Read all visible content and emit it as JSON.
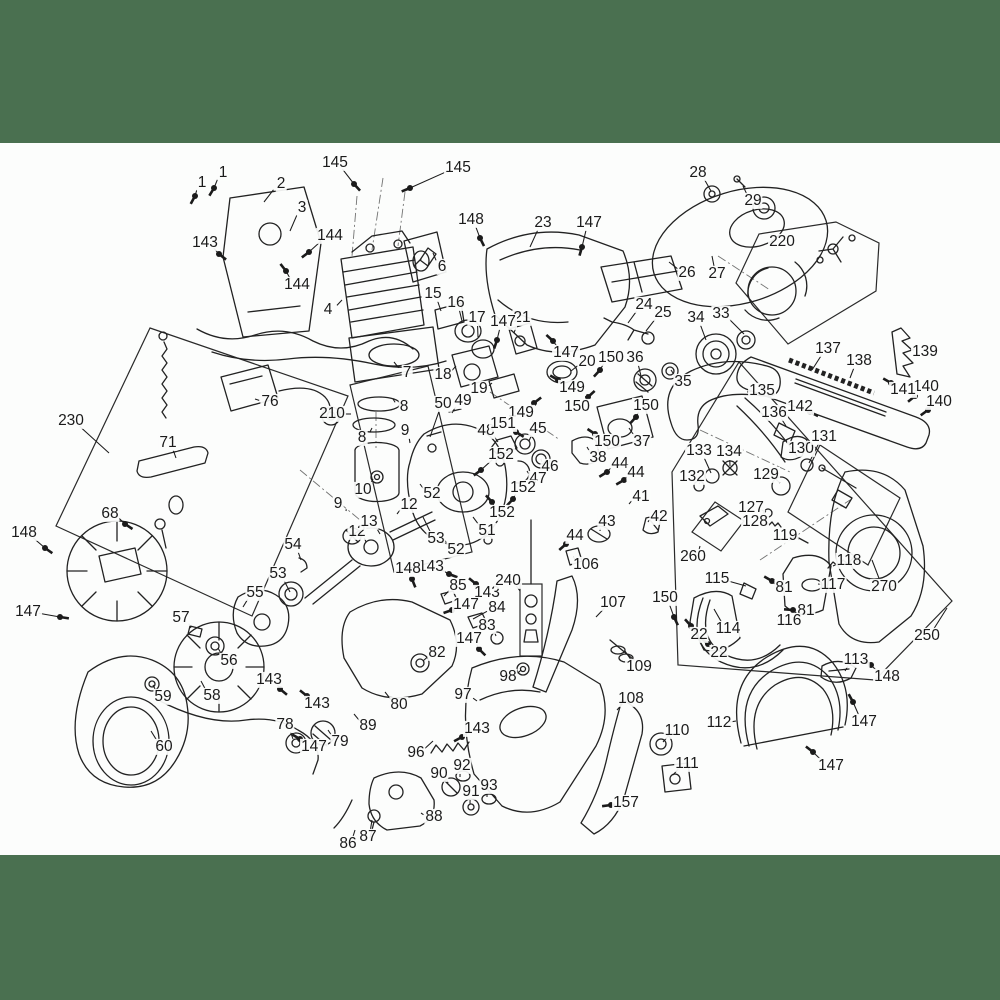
{
  "page": {
    "background": "#fcfdfc",
    "band_color": "#4a7050",
    "top_band": {
      "y": 0,
      "h": 143
    },
    "bottom_band": {
      "y": 855,
      "h": 145
    },
    "line_color": "#222222",
    "description": "Chainsaw exploded-view parts diagram with numbered callouts"
  },
  "callouts": [
    {
      "n": "1",
      "x": 223,
      "y": 173,
      "tx": 214,
      "ty": 188,
      "hw": 1
    },
    {
      "n": "1",
      "x": 202,
      "y": 183,
      "tx": 195,
      "ty": 196,
      "hw": 1
    },
    {
      "n": "2",
      "x": 281,
      "y": 184,
      "tx": 264,
      "ty": 202
    },
    {
      "n": "3",
      "x": 302,
      "y": 208,
      "tx": 290,
      "ty": 231
    },
    {
      "n": "143",
      "x": 205,
      "y": 243,
      "tx": 219,
      "ty": 254,
      "hw": 1
    },
    {
      "n": "144",
      "x": 330,
      "y": 236,
      "tx": 309,
      "ty": 252,
      "hw": 1
    },
    {
      "n": "144",
      "x": 297,
      "y": 285,
      "tx": 286,
      "ty": 271,
      "hw": 1
    },
    {
      "n": "145",
      "x": 335,
      "y": 163,
      "tx": 354,
      "ty": 184,
      "hw": 1
    },
    {
      "n": "145",
      "x": 458,
      "y": 168,
      "tx": 410,
      "ty": 188,
      "hw": 1
    },
    {
      "n": "4",
      "x": 328,
      "y": 310,
      "tx": 342,
      "ty": 300
    },
    {
      "n": "6",
      "x": 442,
      "y": 267,
      "tx": 433,
      "ty": 253
    },
    {
      "n": "7",
      "x": 407,
      "y": 373,
      "tx": 394,
      "ty": 362
    },
    {
      "n": "15",
      "x": 433,
      "y": 294,
      "tx": 441,
      "ty": 311
    },
    {
      "n": "16",
      "x": 456,
      "y": 303,
      "tx": 462,
      "ty": 321
    },
    {
      "n": "17",
      "x": 477,
      "y": 318,
      "tx": 478,
      "ty": 337
    },
    {
      "n": "18",
      "x": 443,
      "y": 375,
      "tx": 456,
      "ty": 366
    },
    {
      "n": "19",
      "x": 479,
      "y": 389,
      "tx": 492,
      "ty": 383
    },
    {
      "n": "20",
      "x": 587,
      "y": 362,
      "tx": 571,
      "ty": 371
    },
    {
      "n": "21",
      "x": 522,
      "y": 318,
      "tx": 514,
      "ty": 333
    },
    {
      "n": "23",
      "x": 543,
      "y": 223,
      "tx": 530,
      "ty": 247
    },
    {
      "n": "24",
      "x": 644,
      "y": 305,
      "tx": 628,
      "ty": 323
    },
    {
      "n": "25",
      "x": 663,
      "y": 313,
      "tx": 646,
      "ty": 331
    },
    {
      "n": "26",
      "x": 687,
      "y": 273,
      "tx": 669,
      "ty": 262
    },
    {
      "n": "27",
      "x": 717,
      "y": 274,
      "tx": 712,
      "ty": 256
    },
    {
      "n": "28",
      "x": 698,
      "y": 173,
      "tx": 711,
      "ty": 191
    },
    {
      "n": "29",
      "x": 753,
      "y": 201,
      "tx": 743,
      "ty": 186
    },
    {
      "n": "33",
      "x": 721,
      "y": 314,
      "tx": 744,
      "ty": 334
    },
    {
      "n": "34",
      "x": 696,
      "y": 318,
      "tx": 706,
      "ty": 340
    },
    {
      "n": "35",
      "x": 683,
      "y": 382,
      "tx": 671,
      "ty": 370
    },
    {
      "n": "36",
      "x": 635,
      "y": 358,
      "tx": 641,
      "ty": 376
    },
    {
      "n": "37",
      "x": 642,
      "y": 442,
      "tx": 629,
      "ty": 428
    },
    {
      "n": "38",
      "x": 598,
      "y": 458,
      "tx": 587,
      "ty": 447
    },
    {
      "n": "41",
      "x": 641,
      "y": 497,
      "tx": 629,
      "ty": 504
    },
    {
      "n": "42",
      "x": 659,
      "y": 517,
      "tx": 648,
      "ty": 522
    },
    {
      "n": "43",
      "x": 607,
      "y": 522,
      "tx": 600,
      "ty": 531
    },
    {
      "n": "44",
      "x": 620,
      "y": 464,
      "tx": 607,
      "ty": 472,
      "hw": 1
    },
    {
      "n": "44",
      "x": 636,
      "y": 473,
      "tx": 624,
      "ty": 480,
      "hw": 1
    },
    {
      "n": "44",
      "x": 575,
      "y": 536,
      "tx": 566,
      "ty": 544,
      "hw": 1
    },
    {
      "n": "45",
      "x": 538,
      "y": 429,
      "tx": 529,
      "ty": 441
    },
    {
      "n": "46",
      "x": 550,
      "y": 467,
      "tx": 541,
      "ty": 459
    },
    {
      "n": "47",
      "x": 538,
      "y": 479,
      "tx": 527,
      "ty": 471
    },
    {
      "n": "48",
      "x": 486,
      "y": 431,
      "tx": 498,
      "ty": 442
    },
    {
      "n": "49",
      "x": 463,
      "y": 401,
      "tx": 452,
      "ty": 413
    },
    {
      "n": "50",
      "x": 443,
      "y": 404,
      "tx": 430,
      "ty": 437
    },
    {
      "n": "51",
      "x": 487,
      "y": 531,
      "tx": 473,
      "ty": 517
    },
    {
      "n": "52",
      "x": 432,
      "y": 494,
      "tx": 420,
      "ty": 484
    },
    {
      "n": "52",
      "x": 456,
      "y": 550,
      "tx": 442,
      "ty": 537
    },
    {
      "n": "53",
      "x": 436,
      "y": 539,
      "tx": 423,
      "ty": 517
    },
    {
      "n": "53",
      "x": 278,
      "y": 574,
      "tx": 290,
      "ty": 592
    },
    {
      "n": "54",
      "x": 293,
      "y": 545,
      "tx": 301,
      "ty": 560
    },
    {
      "n": "55",
      "x": 255,
      "y": 593,
      "tx": 243,
      "ty": 607
    },
    {
      "n": "56",
      "x": 229,
      "y": 661,
      "tx": 218,
      "ty": 648
    },
    {
      "n": "57",
      "x": 181,
      "y": 618,
      "tx": 191,
      "ty": 628
    },
    {
      "n": "58",
      "x": 212,
      "y": 696,
      "tx": 201,
      "ty": 681
    },
    {
      "n": "59",
      "x": 163,
      "y": 697,
      "tx": 153,
      "ty": 685
    },
    {
      "n": "60",
      "x": 164,
      "y": 747,
      "tx": 151,
      "ty": 731
    },
    {
      "n": "68",
      "x": 110,
      "y": 514,
      "tx": 125,
      "ty": 524,
      "hw": 1
    },
    {
      "n": "71",
      "x": 168,
      "y": 443,
      "tx": 176,
      "ty": 458
    },
    {
      "n": "76",
      "x": 270,
      "y": 402,
      "tx": 255,
      "ty": 399
    },
    {
      "n": "78",
      "x": 285,
      "y": 725,
      "tx": 293,
      "ty": 739
    },
    {
      "n": "79",
      "x": 340,
      "y": 742,
      "tx": 328,
      "ty": 730
    },
    {
      "n": "80",
      "x": 399,
      "y": 705,
      "tx": 385,
      "ty": 692
    },
    {
      "n": "81",
      "x": 784,
      "y": 588,
      "tx": 772,
      "ty": 581,
      "hw": 1
    },
    {
      "n": "81",
      "x": 806,
      "y": 611,
      "tx": 793,
      "ty": 610,
      "hw": 1
    },
    {
      "n": "82",
      "x": 437,
      "y": 653,
      "tx": 423,
      "ty": 661
    },
    {
      "n": "83",
      "x": 487,
      "y": 626,
      "tx": 496,
      "ty": 636
    },
    {
      "n": "84",
      "x": 497,
      "y": 608,
      "tx": 473,
      "ty": 619
    },
    {
      "n": "85",
      "x": 458,
      "y": 586,
      "tx": 444,
      "ty": 596
    },
    {
      "n": "86",
      "x": 348,
      "y": 844,
      "tx": 355,
      "ty": 830
    },
    {
      "n": "87",
      "x": 368,
      "y": 837,
      "tx": 372,
      "ty": 820
    },
    {
      "n": "88",
      "x": 434,
      "y": 817,
      "tx": 421,
      "ty": 813
    },
    {
      "n": "89",
      "x": 368,
      "y": 726,
      "tx": 354,
      "ty": 714
    },
    {
      "n": "90",
      "x": 439,
      "y": 774,
      "tx": 448,
      "ty": 783
    },
    {
      "n": "91",
      "x": 471,
      "y": 792,
      "tx": 470,
      "ty": 804
    },
    {
      "n": "92",
      "x": 462,
      "y": 766,
      "tx": 460,
      "ty": 777
    },
    {
      "n": "93",
      "x": 489,
      "y": 786,
      "tx": 487,
      "ty": 797
    },
    {
      "n": "96",
      "x": 416,
      "y": 753,
      "tx": 433,
      "ty": 741
    },
    {
      "n": "97",
      "x": 463,
      "y": 695,
      "tx": 477,
      "ty": 701
    },
    {
      "n": "98",
      "x": 508,
      "y": 677,
      "tx": 521,
      "ty": 670
    },
    {
      "n": "106",
      "x": 586,
      "y": 565,
      "tx": 573,
      "ty": 557
    },
    {
      "n": "107",
      "x": 613,
      "y": 603,
      "tx": 596,
      "ty": 617
    },
    {
      "n": "108",
      "x": 631,
      "y": 699,
      "tx": 617,
      "ty": 710
    },
    {
      "n": "109",
      "x": 639,
      "y": 667,
      "tx": 625,
      "ty": 651
    },
    {
      "n": "110",
      "x": 677,
      "y": 731,
      "tx": 663,
      "ty": 742
    },
    {
      "n": "111",
      "x": 687,
      "y": 764,
      "tx": 673,
      "ty": 775
    },
    {
      "n": "112",
      "x": 719,
      "y": 723,
      "tx": 736,
      "ty": 721
    },
    {
      "n": "113",
      "x": 856,
      "y": 660,
      "tx": 845,
      "ty": 671
    },
    {
      "n": "114",
      "x": 728,
      "y": 629,
      "tx": 714,
      "ty": 609
    },
    {
      "n": "115",
      "x": 717,
      "y": 579,
      "tx": 746,
      "ty": 586
    },
    {
      "n": "116",
      "x": 789,
      "y": 621,
      "tx": 777,
      "ty": 620
    },
    {
      "n": "117",
      "x": 833,
      "y": 585,
      "tx": 818,
      "ty": 584
    },
    {
      "n": "118",
      "x": 849,
      "y": 561,
      "tx": 833,
      "ty": 566
    },
    {
      "n": "119",
      "x": 785,
      "y": 536,
      "tx": 799,
      "ty": 539
    },
    {
      "n": "127",
      "x": 751,
      "y": 508,
      "tx": 766,
      "ty": 512
    },
    {
      "n": "128",
      "x": 755,
      "y": 522,
      "tx": 768,
      "ty": 525
    },
    {
      "n": "129",
      "x": 766,
      "y": 475,
      "tx": 780,
      "ty": 483
    },
    {
      "n": "130",
      "x": 801,
      "y": 449,
      "tx": 789,
      "ty": 450
    },
    {
      "n": "131",
      "x": 824,
      "y": 437,
      "tx": 809,
      "ty": 463
    },
    {
      "n": "132",
      "x": 692,
      "y": 477,
      "tx": 699,
      "ty": 484
    },
    {
      "n": "133",
      "x": 699,
      "y": 451,
      "tx": 711,
      "ty": 473
    },
    {
      "n": "134",
      "x": 729,
      "y": 452,
      "tx": 730,
      "ty": 466
    },
    {
      "n": "135",
      "x": 762,
      "y": 391,
      "tx": 747,
      "ty": 392
    },
    {
      "n": "136",
      "x": 774,
      "y": 413,
      "tx": 786,
      "ty": 426
    },
    {
      "n": "137",
      "x": 828,
      "y": 349,
      "tx": 812,
      "ty": 370
    },
    {
      "n": "138",
      "x": 859,
      "y": 361,
      "tx": 850,
      "ty": 378
    },
    {
      "n": "139",
      "x": 925,
      "y": 352,
      "tx": 912,
      "ty": 349
    },
    {
      "n": "140",
      "x": 926,
      "y": 387,
      "tx": 915,
      "ty": 396,
      "hw": 1
    },
    {
      "n": "140",
      "x": 939,
      "y": 402,
      "tx": 928,
      "ty": 410,
      "hw": 1
    },
    {
      "n": "141",
      "x": 903,
      "y": 390,
      "tx": 891,
      "ty": 383,
      "hw": 1
    },
    {
      "n": "142",
      "x": 800,
      "y": 407,
      "tx": 810,
      "ty": 412,
      "hw": 1
    },
    {
      "n": "143",
      "x": 431,
      "y": 567,
      "tx": 449,
      "ty": 574,
      "hw": 1
    },
    {
      "n": "143",
      "x": 487,
      "y": 593,
      "tx": 476,
      "ty": 584,
      "hw": 1
    },
    {
      "n": "143",
      "x": 269,
      "y": 680,
      "tx": 280,
      "ty": 689,
      "hw": 1
    },
    {
      "n": "143",
      "x": 317,
      "y": 704,
      "tx": 307,
      "ty": 696,
      "hw": 1
    },
    {
      "n": "143",
      "x": 477,
      "y": 729,
      "tx": 462,
      "ty": 737,
      "hw": 1
    },
    {
      "n": "147",
      "x": 589,
      "y": 223,
      "tx": 582,
      "ty": 247,
      "hw": 1
    },
    {
      "n": "147",
      "x": 503,
      "y": 322,
      "tx": 497,
      "ty": 340,
      "hw": 1
    },
    {
      "n": "147",
      "x": 566,
      "y": 353,
      "tx": 553,
      "ty": 341,
      "hw": 1
    },
    {
      "n": "147",
      "x": 28,
      "y": 612,
      "tx": 60,
      "ty": 617,
      "hw": 1
    },
    {
      "n": "147",
      "x": 466,
      "y": 605,
      "tx": 452,
      "ty": 610,
      "hw": 1
    },
    {
      "n": "147",
      "x": 469,
      "y": 639,
      "tx": 479,
      "ty": 649,
      "hw": 1
    },
    {
      "n": "147",
      "x": 314,
      "y": 747,
      "tx": 300,
      "ty": 739,
      "hw": 1
    },
    {
      "n": "147",
      "x": 864,
      "y": 722,
      "tx": 853,
      "ty": 702,
      "hw": 1
    },
    {
      "n": "147",
      "x": 831,
      "y": 766,
      "tx": 813,
      "ty": 752,
      "hw": 1
    },
    {
      "n": "148",
      "x": 471,
      "y": 220,
      "tx": 480,
      "ty": 238,
      "hw": 1
    },
    {
      "n": "148",
      "x": 24,
      "y": 533,
      "tx": 45,
      "ty": 548,
      "hw": 1
    },
    {
      "n": "148",
      "x": 408,
      "y": 569,
      "tx": 412,
      "ty": 579,
      "hw": 1
    },
    {
      "n": "148",
      "x": 887,
      "y": 677,
      "tx": 871,
      "ty": 665,
      "hw": 1
    },
    {
      "n": "149",
      "x": 572,
      "y": 388,
      "tx": 558,
      "ty": 380,
      "hw": 1
    },
    {
      "n": "149",
      "x": 521,
      "y": 413,
      "tx": 534,
      "ty": 403,
      "hw": 1
    },
    {
      "n": "150",
      "x": 611,
      "y": 358,
      "tx": 600,
      "ty": 370,
      "hw": 1
    },
    {
      "n": "150",
      "x": 577,
      "y": 407,
      "tx": 588,
      "ty": 397,
      "hw": 1
    },
    {
      "n": "150",
      "x": 646,
      "y": 406,
      "tx": 636,
      "ty": 417,
      "hw": 1
    },
    {
      "n": "150",
      "x": 607,
      "y": 442,
      "tx": 595,
      "ty": 434,
      "hw": 1
    },
    {
      "n": "150",
      "x": 665,
      "y": 598,
      "tx": 674,
      "ty": 617,
      "hw": 1
    },
    {
      "n": "151",
      "x": 503,
      "y": 424,
      "tx": 516,
      "ty": 432,
      "hw": 1
    },
    {
      "n": "152",
      "x": 501,
      "y": 455,
      "tx": 481,
      "ty": 470,
      "hw": 1
    },
    {
      "n": "152",
      "x": 523,
      "y": 488,
      "tx": 513,
      "ty": 499,
      "hw": 1
    },
    {
      "n": "152",
      "x": 502,
      "y": 513,
      "tx": 492,
      "ty": 502,
      "hw": 1
    },
    {
      "n": "157",
      "x": 626,
      "y": 803,
      "tx": 611,
      "ty": 805,
      "hw": 1
    },
    {
      "n": "8",
      "x": 404,
      "y": 407,
      "tx": 393,
      "ty": 399
    },
    {
      "n": "8",
      "x": 362,
      "y": 438,
      "tx": 372,
      "ty": 428
    },
    {
      "n": "9",
      "x": 405,
      "y": 431,
      "tx": 410,
      "ty": 443
    },
    {
      "n": "9",
      "x": 338,
      "y": 504,
      "tx": 346,
      "ty": 511
    },
    {
      "n": "10",
      "x": 363,
      "y": 490,
      "tx": 373,
      "ty": 479
    },
    {
      "n": "12",
      "x": 409,
      "y": 505,
      "tx": 397,
      "ty": 514
    },
    {
      "n": "12",
      "x": 357,
      "y": 532,
      "tx": 366,
      "ty": 542
    },
    {
      "n": "13",
      "x": 369,
      "y": 522,
      "tx": 380,
      "ty": 534
    },
    {
      "n": "22",
      "x": 699,
      "y": 635,
      "tx": 691,
      "ty": 626,
      "hw": 1
    },
    {
      "n": "22",
      "x": 719,
      "y": 653,
      "tx": 708,
      "ty": 644,
      "hw": 1
    },
    {
      "n": "210",
      "x": 332,
      "y": 414,
      "tx": 351,
      "ty": 414
    },
    {
      "n": "220",
      "x": 782,
      "y": 242
    },
    {
      "n": "230",
      "x": 71,
      "y": 421,
      "tx": 109,
      "ty": 453
    },
    {
      "n": "240",
      "x": 508,
      "y": 581,
      "tx": 520,
      "ty": 591
    },
    {
      "n": "250",
      "x": 927,
      "y": 636,
      "tx": 947,
      "ty": 608
    },
    {
      "n": "260",
      "x": 693,
      "y": 557,
      "tx": 700,
      "ty": 546
    },
    {
      "n": "270",
      "x": 884,
      "y": 587,
      "tx": 872,
      "ty": 560
    }
  ]
}
